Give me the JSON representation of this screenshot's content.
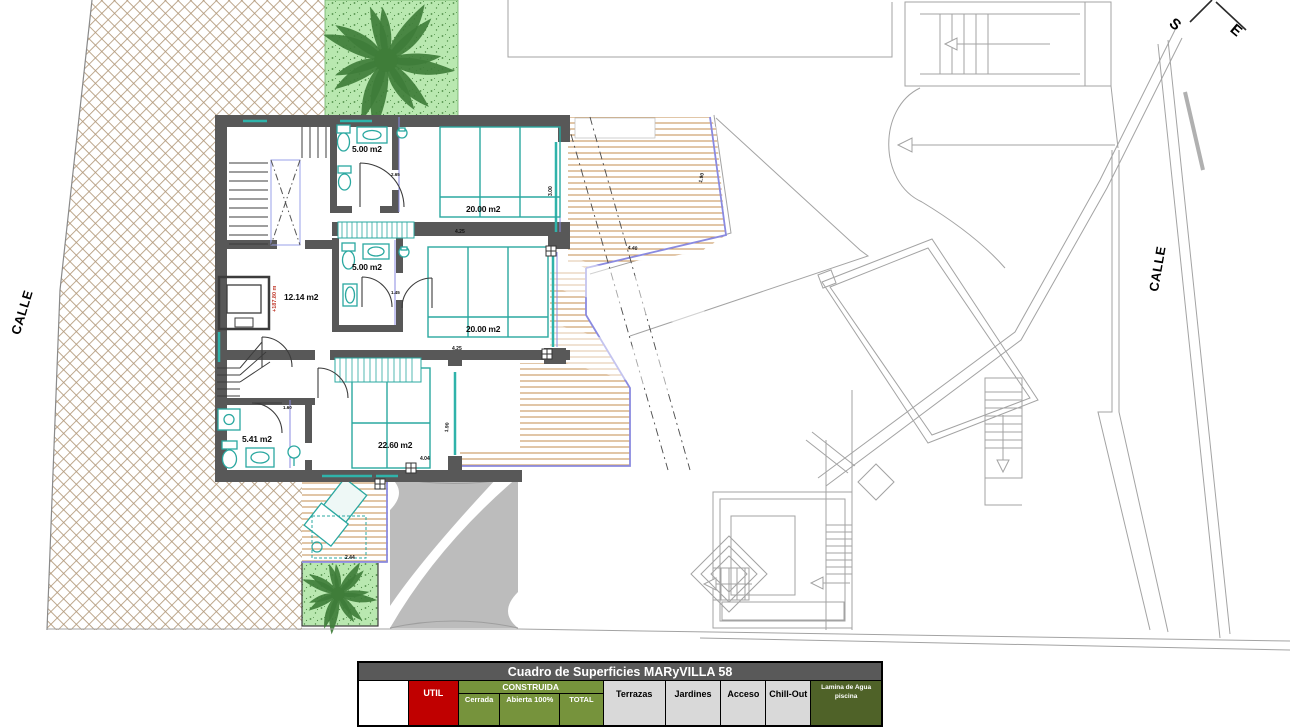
{
  "plan": {
    "streets": {
      "left": "CALLE",
      "right": "CALLE"
    },
    "compass": {
      "s": "S",
      "e": "E"
    },
    "level_mark": "+187.80 m",
    "rooms": {
      "bath_top": "5.00 m2",
      "bed_top": "20.00 m2",
      "hall": "12.14 m2",
      "bath_mid": "5.00 m2",
      "bed_mid": "20.00 m2",
      "bath_low": "5.41 m2",
      "bed_low": "22.60 m2"
    },
    "dims": {
      "a": "4.25",
      "b": "2.65",
      "c": "3.00",
      "d": "4.25",
      "e": "1.45",
      "f": "1.60",
      "g": "4.04",
      "h": "2.44",
      "i": "4.40",
      "j": "1.90",
      "k": "1.90"
    }
  },
  "table": {
    "title": "Cuadro de Superficies MARyVILLA 58",
    "util": "UTIL",
    "construida": "CONSTRUIDA",
    "cerrada": "Cerrada",
    "abierta": "Abierta 100%",
    "total": "TOTAL",
    "terrazas": "Terrazas",
    "jardines": "Jardines",
    "acceso": "Acceso",
    "chillout": "Chill-Out",
    "lamina_line1": "Lamina de Agua",
    "lamina_line2": "piscina"
  },
  "colors": {
    "wall": "#585858",
    "fixture_teal": "#2aa8a0",
    "blue_trim": "#8a8ae0",
    "wood": "#c9975f",
    "lattice": "#b49b7d",
    "garden": "#b9e8b0",
    "palm": "#3f7d39",
    "level_red": "#c0392b",
    "table_red": "#c00000",
    "table_green": "#76933c",
    "table_dark_green": "#4f6228",
    "table_gray": "#d9d9d9",
    "title_gray": "#595959"
  }
}
